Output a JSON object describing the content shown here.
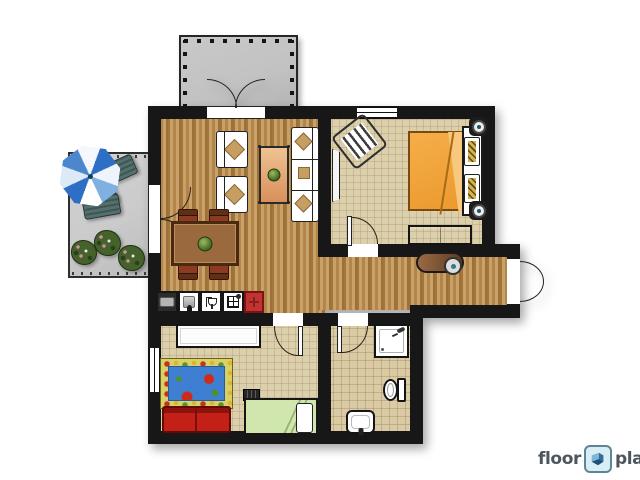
{
  "logo": {
    "word_left": "floor",
    "word_right": "planner",
    "icon": "floorplanner-mark-icon"
  },
  "palette": {
    "wall": "#171717",
    "wood_light": "#c9a066",
    "wood_dark": "#a1763c",
    "carpet": "#dcd0ac",
    "tile": "#dacba4",
    "balcony_gray": "#c2c2c2",
    "patio_gray": "#cbcbcb",
    "bed_orange": "#f6ae49",
    "kids_sofa_red": "#c32018",
    "kids_bed_green": "#d0e6ae",
    "rug_blue": "#3f7fd2",
    "rug_border_yellow": "#d8d168",
    "fridge_red": "#c03434",
    "umbrella_blue": "#2d6fc4",
    "patio_furniture_teal": "#3c5654",
    "dining_table_brown": "#9a6a3e",
    "coffee_table_tan": "#f0c292",
    "cushion_tan": "#c79e62",
    "bench_light": "#9a6a44",
    "logo_text_gray": "#4d565c",
    "logo_icon_blue_bg": "#d9edf5"
  },
  "plan": {
    "rooms": [
      {
        "name": "balcony",
        "type": "outdoor",
        "floor": "concrete",
        "features": [
          "railing-posts",
          "double-french-doors"
        ]
      },
      {
        "name": "patio",
        "type": "outdoor",
        "floor": "paving",
        "furniture": [
          "parasol",
          "lounge-chair",
          "side-table",
          "lounge-chair",
          "bush",
          "bush",
          "bush"
        ]
      },
      {
        "name": "living-room",
        "floor": "wood-planks",
        "furniture": [
          "armchair",
          "armchair",
          "coffee-table-with-plant",
          "three-seat-sofa",
          "dining-table-with-plant",
          "dining-chair",
          "dining-chair",
          "dining-chair",
          "dining-chair"
        ]
      },
      {
        "name": "kitchen",
        "floor": "wood-planks",
        "furniture": [
          "microwave-counter",
          "sink-counter",
          "dishwasher-counter",
          "stove-counter",
          "red-counter-unit"
        ]
      },
      {
        "name": "bedroom",
        "floor": "carpet",
        "furniture": [
          "striped-armchair",
          "wardrobe",
          "double-bed-orange",
          "bedside-speaker",
          "bedside-speaker",
          "low-dresser"
        ],
        "features": [
          "window"
        ]
      },
      {
        "name": "hallway",
        "floor": "wood-planks",
        "furniture": [
          "bench-with-round-cushion"
        ],
        "features": [
          "front-door"
        ]
      },
      {
        "name": "kids-room",
        "floor": "carpet",
        "furniture": [
          "white-sideboard",
          "flower-play-rug",
          "red-two-seat-sofa",
          "wall-shelf",
          "single-bed-green"
        ],
        "features": [
          "window"
        ]
      },
      {
        "name": "bathroom",
        "floor": "tiles",
        "furniture": [
          "shower-cabin",
          "toilet",
          "washbasin"
        ]
      }
    ]
  }
}
